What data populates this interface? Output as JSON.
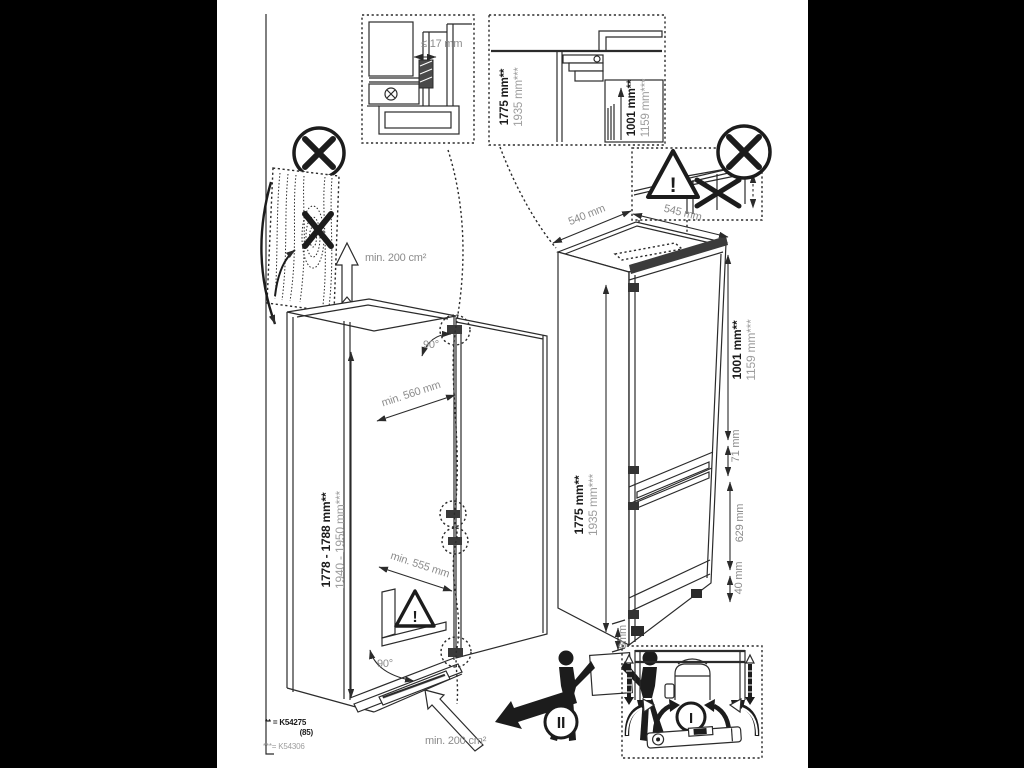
{
  "colors": {
    "background": "#000000",
    "paper": "#ffffff",
    "line": "#2b2b2b",
    "dim_text": "#8c8c8c",
    "alt_text": "#9d9d9d",
    "bold_text": "#1b1b1b"
  },
  "hinge_detail": {
    "clearance": "≤ 17 mm"
  },
  "top_section": {
    "height_bold": "1775 mm**",
    "height_alt": "1935 mm***",
    "upper_bold": "1001 mm**",
    "upper_alt": "1159 mm***"
  },
  "warning": {
    "exclamation": "!"
  },
  "niche": {
    "height_bold": "1778 - 1788 mm**",
    "height_alt": "1940 - 1950 mm***",
    "depth": "min. 560 mm",
    "width": "min. 555 mm",
    "door_angle_top": "90°",
    "door_angle_bottom": "90°",
    "vent_area_top": "min. 200 cm²",
    "vent_area_bottom": "min. 200 cm²"
  },
  "appliance": {
    "depth": "540 mm",
    "depth_with_door": "545 mm",
    "height_bold": "1775 mm**",
    "height_alt": "1935 mm***",
    "upper_door_bold": "1001 mm**",
    "upper_door_alt": "1159 mm***",
    "door_gap": "71 mm",
    "lower_door": "629 mm",
    "plinth": "40 mm",
    "base_gap": "8mm"
  },
  "steps": {
    "carry": "II",
    "level": "I"
  },
  "footnotes": {
    "line1": "** = K54275",
    "line2": "(85)",
    "line3": "***= K54306"
  }
}
